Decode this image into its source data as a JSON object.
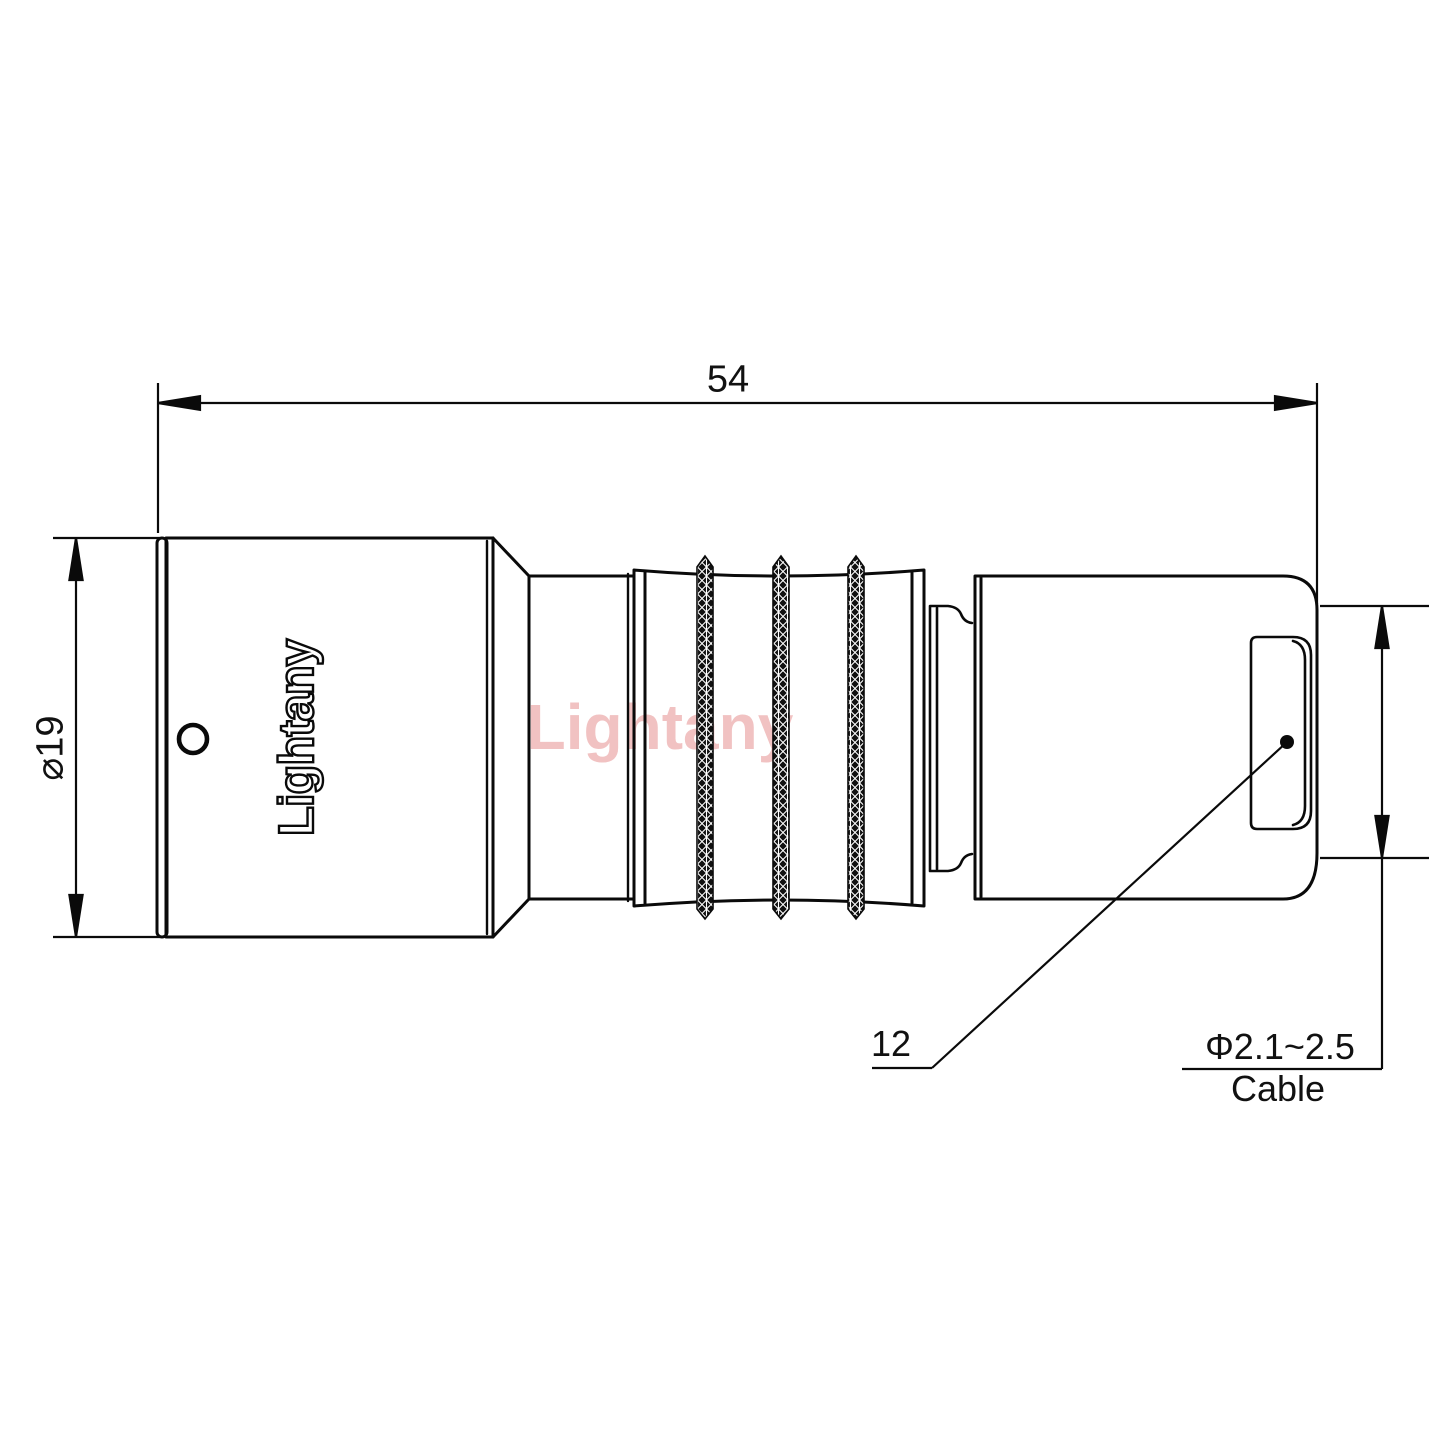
{
  "drawing": {
    "kind": "connector-technical-drawing",
    "view": "side-view",
    "watermark": {
      "text": "Lightany",
      "color": "#f1c2c2"
    },
    "body_logo": {
      "text": "Lightany"
    },
    "dimensions": {
      "overall_length": "54",
      "outer_diameter": "⌀19",
      "bushing_ref": "12",
      "cable_range": "Φ2.1~2.5",
      "cable_label": "Cable"
    },
    "colors": {
      "line": "#0a0a0a",
      "background": "#ffffff",
      "watermark": "#f1c2c2",
      "knurl_fill": "#111111"
    }
  }
}
